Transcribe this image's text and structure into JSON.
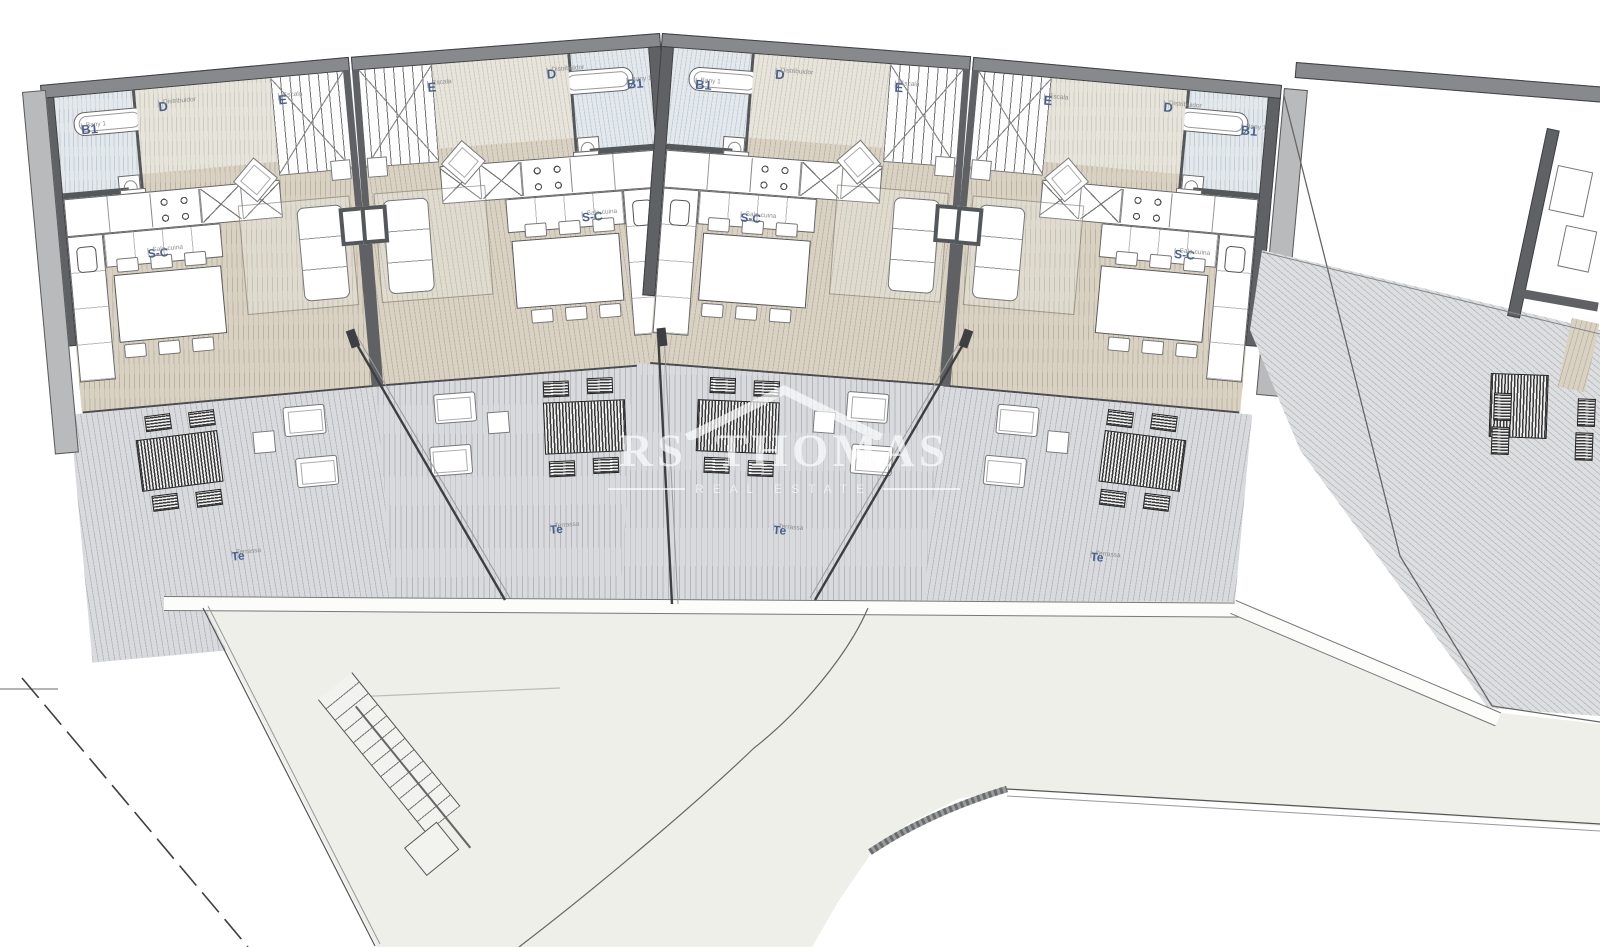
{
  "plan": {
    "type": "residential-floor-plan",
    "orientation": "four mirrored duplex units in an arc with front terraces, neighbouring unit at right, access path and road below"
  },
  "units": [
    {
      "bath_code": "B1",
      "bath_name": "Bany 1",
      "dist_code": "D",
      "dist_name": "Distribuidor",
      "stairs_code": "E",
      "stairs_name": "Escala",
      "living_code": "S-C",
      "living_name": "Sala-cuina",
      "terrace_code": "Te",
      "terrace_name": "Terrassa"
    },
    {
      "bath_code": "B1",
      "bath_name": "Bany 1",
      "dist_code": "D",
      "dist_name": "Distribuidor",
      "stairs_code": "E",
      "stairs_name": "Escala",
      "living_code": "S-C",
      "living_name": "Sala-cuina",
      "terrace_code": "Te",
      "terrace_name": "Terrassa"
    },
    {
      "bath_code": "B1",
      "bath_name": "Bany 1",
      "dist_code": "D",
      "dist_name": "Distribuidor",
      "stairs_code": "E",
      "stairs_name": "Escala",
      "living_code": "S-C",
      "living_name": "Sala-cuina",
      "terrace_code": "Te",
      "terrace_name": "Terrassa"
    },
    {
      "bath_code": "B1",
      "bath_name": "Bany 1",
      "dist_code": "D",
      "dist_name": "Distribuidor",
      "stairs_code": "E",
      "stairs_name": "Escala",
      "living_code": "S-C",
      "living_name": "Sala-cuina",
      "terrace_code": "Te",
      "terrace_name": "Terrassa"
    }
  ],
  "watermark": {
    "brand": "RS THOMAS",
    "tagline": "REAL ESTATE"
  },
  "colors": {
    "wall": "#5f6164",
    "roof_band": "#87898c",
    "label_blue": "#46618f",
    "label_gray": "#8d8d8d",
    "floor_beige": "#d9d2c3",
    "bath_blue": "#e3e8ec",
    "terrace_gray": "#d8dadd",
    "ground_green": "#edefe8"
  }
}
